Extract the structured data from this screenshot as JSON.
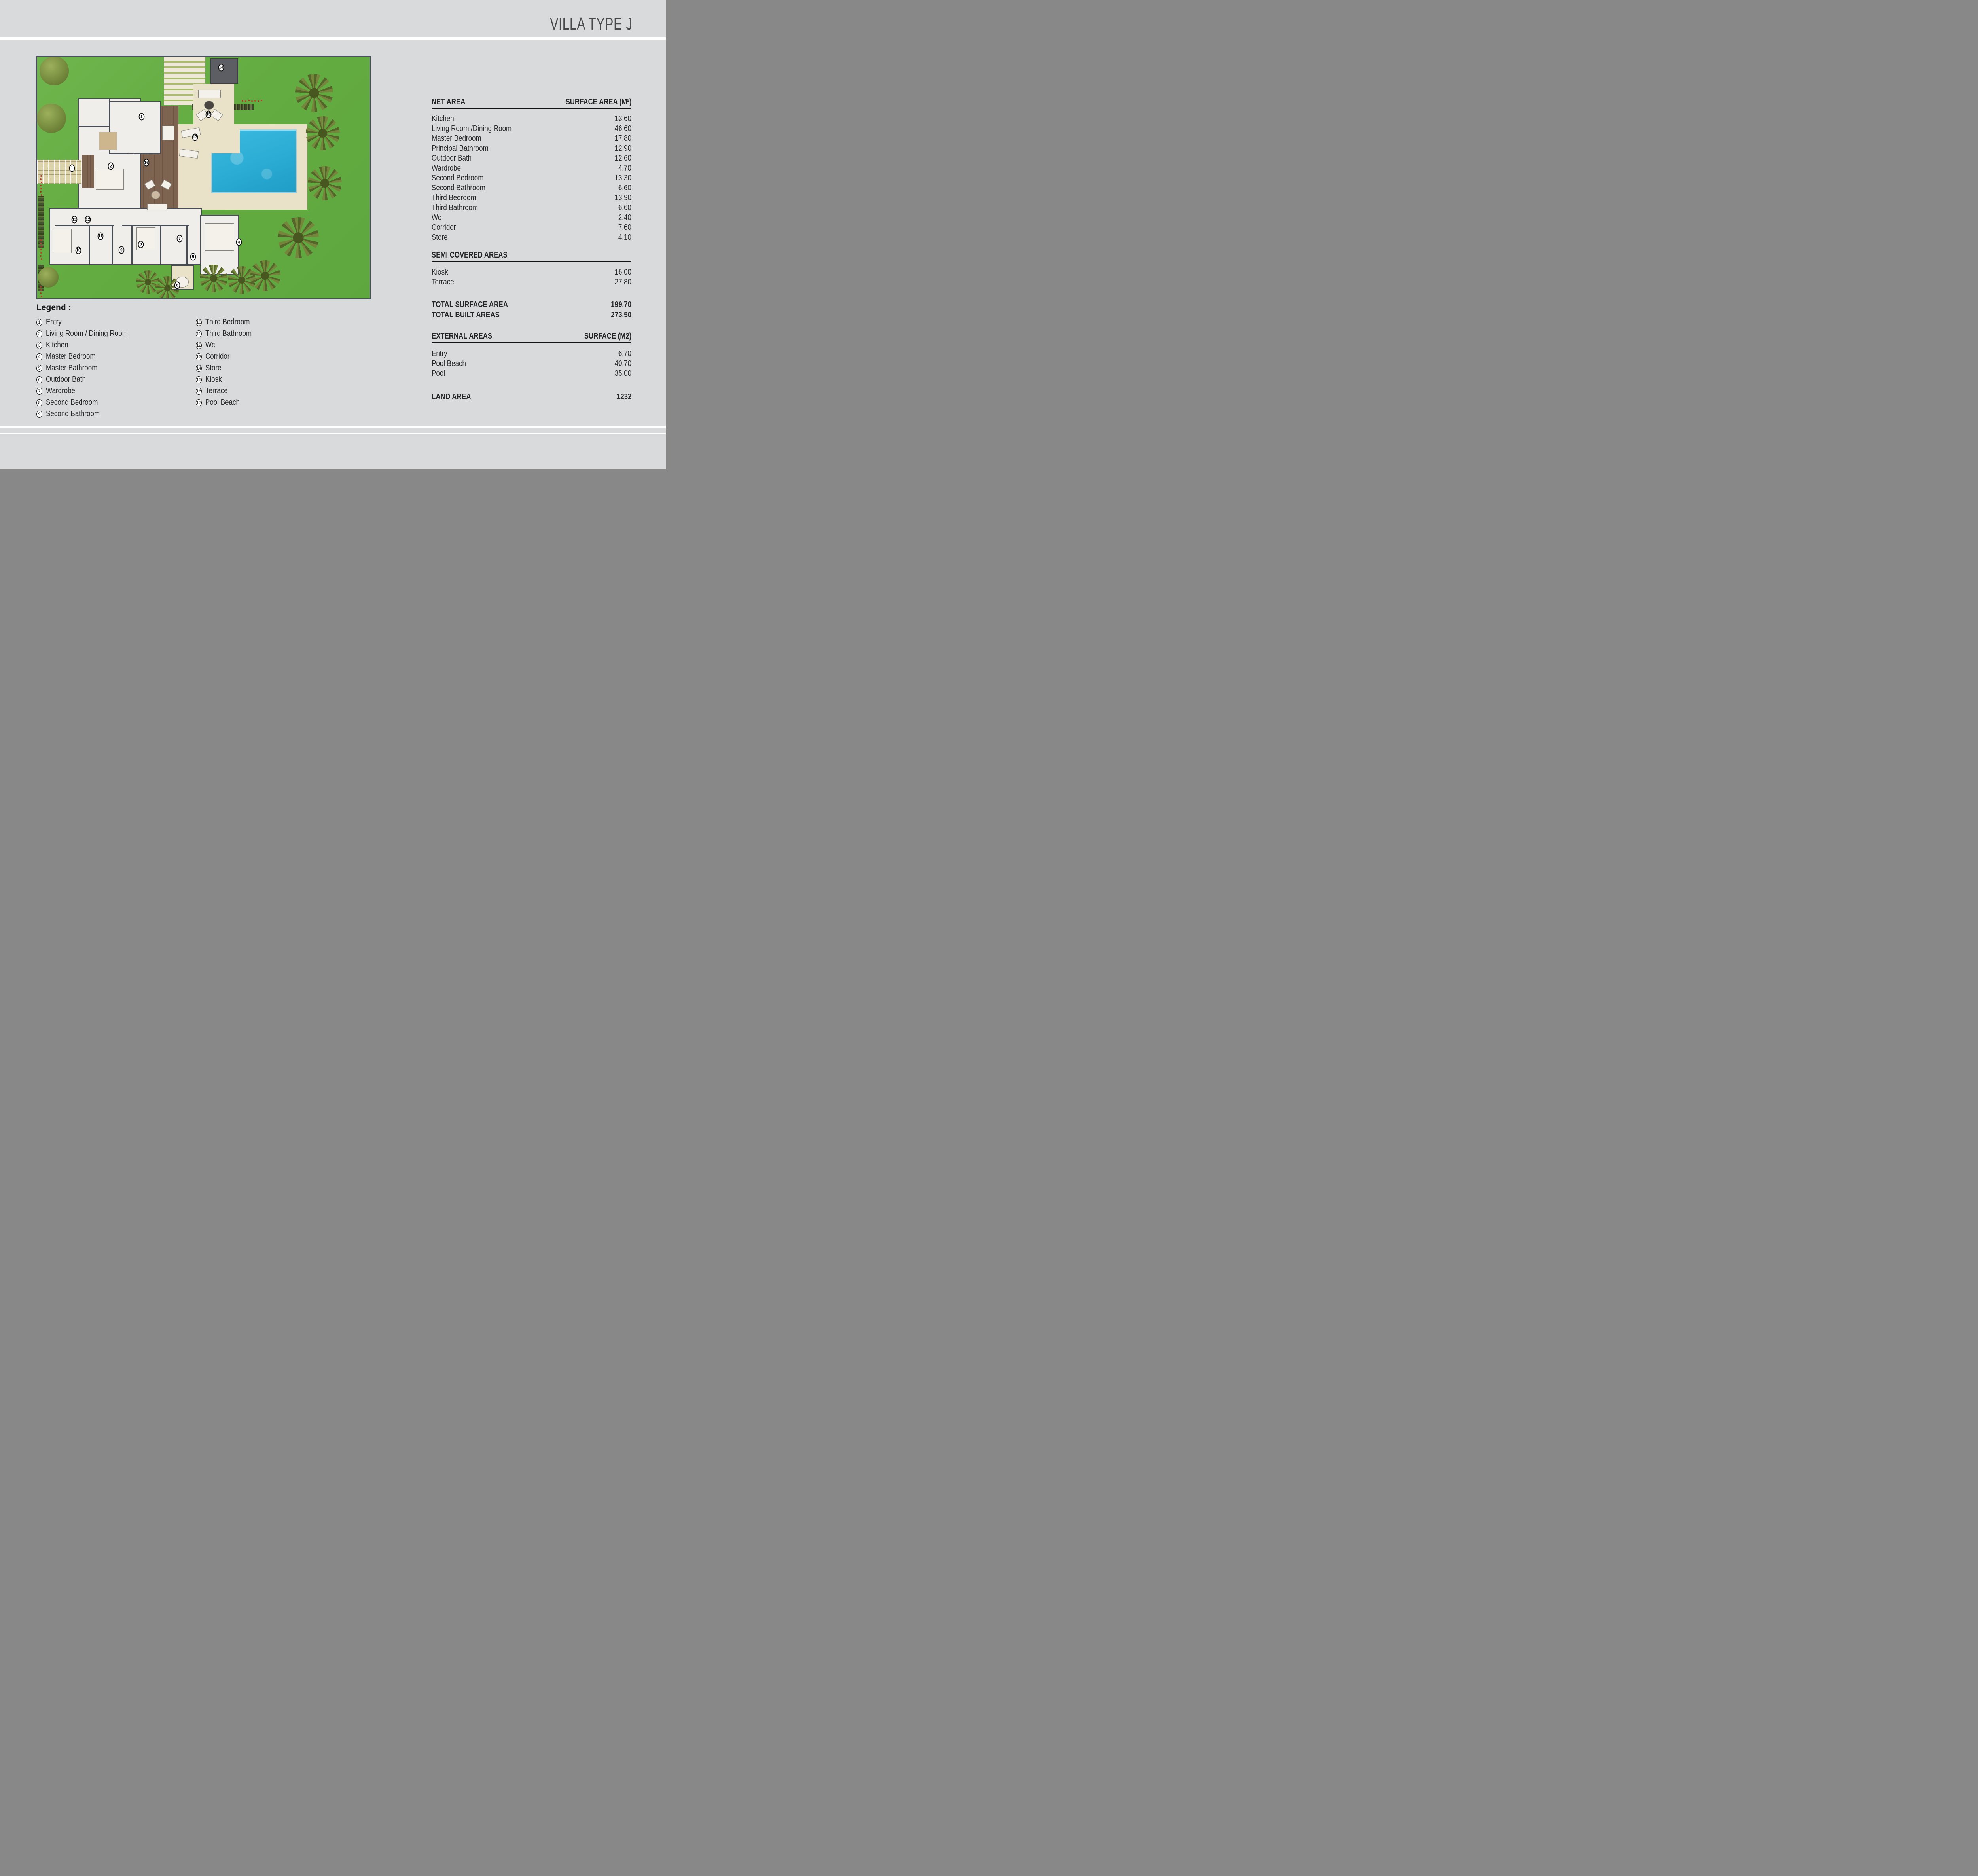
{
  "title": "VILLA TYPE J",
  "tables": {
    "net_area": {
      "header_left": "NET AREA",
      "header_right": "SURFACE AREA (M²)",
      "rows": [
        {
          "label": "Kitchen",
          "value": "13.60"
        },
        {
          "label": "Living Room /Dining Room",
          "value": "46.60"
        },
        {
          "label": "Master Bedroom",
          "value": "17.80"
        },
        {
          "label": "Principal Bathroom",
          "value": "12.90"
        },
        {
          "label": "Outdoor Bath",
          "value": "12.60"
        },
        {
          "label": "Wardrobe",
          "value": "4.70"
        },
        {
          "label": "Second Bedroom",
          "value": "13.30"
        },
        {
          "label": "Second Bathroom",
          "value": "6.60"
        },
        {
          "label": "Third Bedroom",
          "value": "13.90"
        },
        {
          "label": "Third Bathroom",
          "value": "6.60"
        },
        {
          "label": "Wc",
          "value": "2.40"
        },
        {
          "label": "Corridor",
          "value": "7.60"
        },
        {
          "label": "Store",
          "value": "4.10"
        }
      ]
    },
    "semi_covered": {
      "header_left": "SEMI COVERED AREAS",
      "rows": [
        {
          "label": "Kiosk",
          "value": "16.00"
        },
        {
          "label": "Terrace",
          "value": "27.80"
        }
      ],
      "totals": [
        {
          "label": "TOTAL SURFACE AREA",
          "value": "199.70"
        },
        {
          "label": "TOTAL BUILT AREAS",
          "value": "273.50"
        }
      ]
    },
    "external": {
      "header_left": "EXTERNAL AREAS",
      "header_right": "SURFACE (M2)",
      "rows": [
        {
          "label": "Entry",
          "value": "6.70"
        },
        {
          "label": "Pool Beach",
          "value": "40.70"
        },
        {
          "label": "Pool",
          "value": "35.00"
        }
      ],
      "land": [
        {
          "label": "LAND AREA",
          "value": "1232"
        }
      ]
    }
  },
  "legend": {
    "heading": "Legend :",
    "left": [
      {
        "n": "1",
        "label": "Entry"
      },
      {
        "n": "2",
        "label": "Living Room / Dining Room"
      },
      {
        "n": "3",
        "label": "Kitchen"
      },
      {
        "n": "4",
        "label": "Master Bedroom"
      },
      {
        "n": "5",
        "label": "Master Bathroom"
      },
      {
        "n": "6",
        "label": "Outdoor Bath"
      },
      {
        "n": "7",
        "label": "Wardrobe"
      },
      {
        "n": "8",
        "label": "Second Bedroom"
      },
      {
        "n": "9",
        "label": "Second Bathroom"
      }
    ],
    "right": [
      {
        "n": "10",
        "label": "Third Bedroom"
      },
      {
        "n": "11",
        "label": "Third Bathroom"
      },
      {
        "n": "12",
        "label": "Wc"
      },
      {
        "n": "13",
        "label": "Corridor"
      },
      {
        "n": "14",
        "label": "Store"
      },
      {
        "n": "15",
        "label": "Kiosk"
      },
      {
        "n": "16",
        "label": "Terrace"
      },
      {
        "n": "17",
        "label": "Pool Beach"
      }
    ]
  },
  "plan": {
    "markers": [
      "1",
      "2",
      "3",
      "4",
      "5",
      "6",
      "7",
      "8",
      "9",
      "10",
      "11",
      "12",
      "13",
      "14",
      "15",
      "16",
      "17"
    ]
  },
  "colors": {
    "page_bg": "#d9dadc",
    "ink": "#232426",
    "grass": "#68b245",
    "pool": "#2db1d8",
    "sand": "#e9e2c8",
    "deck": "#7e6450",
    "wall": "#474d57",
    "floor": "#efeeea",
    "store": "#5d5e63",
    "flred": "#b03a2e"
  }
}
